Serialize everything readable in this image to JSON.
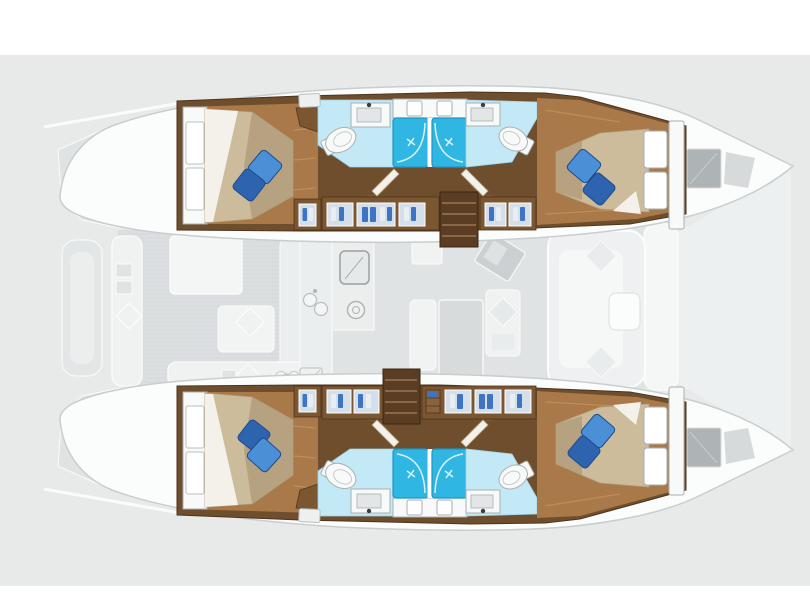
{
  "plan": {
    "vessel": "catamaran",
    "view": "top-down interior layout plan",
    "bow_direction": "right",
    "hulls": [
      {
        "name": "port-hull",
        "position": "top",
        "rooms": [
          {
            "name": "aft-cabin",
            "features": [
              "double-berth",
              "2-decorative-pillows",
              "headboard-panels"
            ]
          },
          {
            "name": "aft-bathroom",
            "features": [
              "sink",
              "toilet",
              "shower-stall"
            ]
          },
          {
            "name": "forward-bathroom",
            "features": [
              "sink",
              "toilet",
              "shower-stall"
            ]
          },
          {
            "name": "forward-cabin",
            "features": [
              "double-berth",
              "2-decorative-pillows",
              "headboard-panels"
            ]
          },
          {
            "name": "wardrobe-row",
            "features": [
              "hanging-lockers",
              "companionway-steps"
            ]
          }
        ]
      },
      {
        "name": "starboard-hull",
        "position": "bottom",
        "rooms": [
          {
            "name": "aft-cabin",
            "features": [
              "double-berth",
              "2-decorative-pillows",
              "headboard-panels"
            ]
          },
          {
            "name": "aft-bathroom",
            "features": [
              "sink",
              "toilet",
              "shower-stall"
            ]
          },
          {
            "name": "forward-bathroom",
            "features": [
              "sink",
              "toilet",
              "shower-stall"
            ]
          },
          {
            "name": "forward-cabin",
            "features": [
              "double-berth",
              "2-decorative-pillows",
              "headboard-panels"
            ]
          },
          {
            "name": "wardrobe-row",
            "features": [
              "hanging-lockers",
              "companionway-steps"
            ]
          }
        ]
      }
    ],
    "center_deck": {
      "aft_cockpit": [
        "bench-seats",
        "cockpit-table",
        "seat-cushions",
        "round-dials"
      ],
      "saloon": [
        "galley-counter",
        "stove",
        "double-sink",
        "fridge",
        "dining-table",
        "dining-bench",
        "nav-station",
        "nav-seat"
      ],
      "forward_cockpit": [
        "u-shaped-seat",
        "two-cushions",
        "small-table"
      ],
      "foredeck": [
        "trampoline",
        "deck-hatch-port",
        "deck-hatch-starboard"
      ]
    },
    "totals": {
      "cabins": 4,
      "bathrooms": 4,
      "showers": 4,
      "berths": 4,
      "pillows": 8
    }
  },
  "colors": {
    "background": "#e8eaea",
    "band-white": "#ffffff",
    "hull-white": "#fbfcfc",
    "hull-outline": "#c9cdce",
    "ghost-floor": "#dcdfe0",
    "ghost-saloon": "#e0e3e4",
    "ghost-furniture": "#f0f2f2",
    "ghost-outline": "#fafbfb",
    "tramp": "#edf0f0",
    "wood-frame": "#6e4e2d",
    "wood-frame-edge": "#4e351b",
    "wood-floor": "#a9794a",
    "wood-floor-streak": "#c79a63",
    "wood-locker": "#7a5631",
    "steps-wood": "#5a3d22",
    "steps-slat": "#8a6847",
    "mattress": "#ccbc9b",
    "mattress-shade": "#b29e7b",
    "sheet-white": "#f3f1ea",
    "pillow-light": "#4b8fd6",
    "pillow-dark": "#2e63b0",
    "pillow-edge": "#1f4a8c",
    "bath-floor": "#c4e9f6",
    "shower-blue": "#2fb6e2",
    "shower-edge": "#1d96c4",
    "fixture-white": "#f8f9f9",
    "fixture-outline": "#a9afb1",
    "locker-window": "#d5dfe9",
    "clothes-blue": "#3f74c4",
    "clothes-white": "#e9eef3",
    "hatch-gray": "#aeb3b5",
    "hatch-light": "#d6dadb"
  }
}
